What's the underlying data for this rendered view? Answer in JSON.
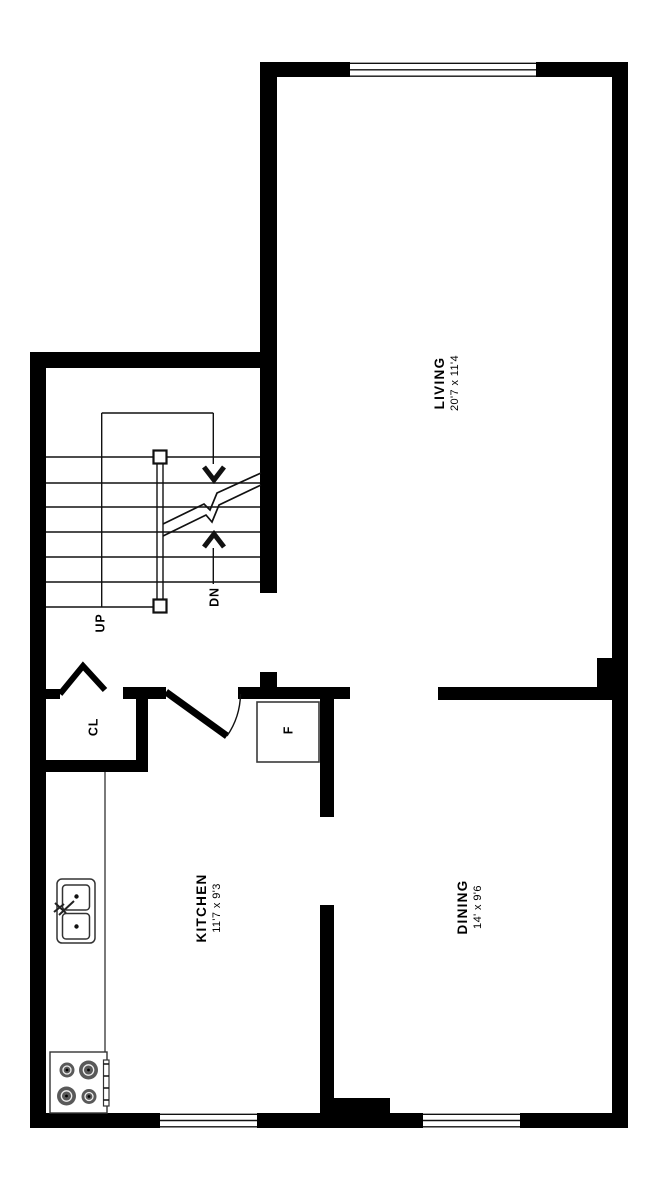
{
  "plan": {
    "type": "floorplan",
    "colors": {
      "wall": "#000000",
      "background": "#ffffff",
      "line": "#111111",
      "burner": "#595959"
    },
    "rooms": [
      {
        "id": "living",
        "name": "LIVING",
        "dims": "20'7 x 11'4"
      },
      {
        "id": "dining",
        "name": "DINING",
        "dims": "14' x 9'6"
      },
      {
        "id": "kitchen",
        "name": "KITCHEN",
        "dims": "11'7 x 9'3"
      }
    ],
    "annotations": {
      "up": "UP",
      "down": "DN",
      "closet": "CL",
      "fridge": "F"
    },
    "features": [
      "stairs",
      "handrail",
      "stair-break-line",
      "closet-bifold-door",
      "kitchen-door",
      "refrigerator",
      "kitchen-counter",
      "double-sink",
      "stove-4-burners",
      "window-top",
      "window-kitchen",
      "window-dining"
    ]
  }
}
